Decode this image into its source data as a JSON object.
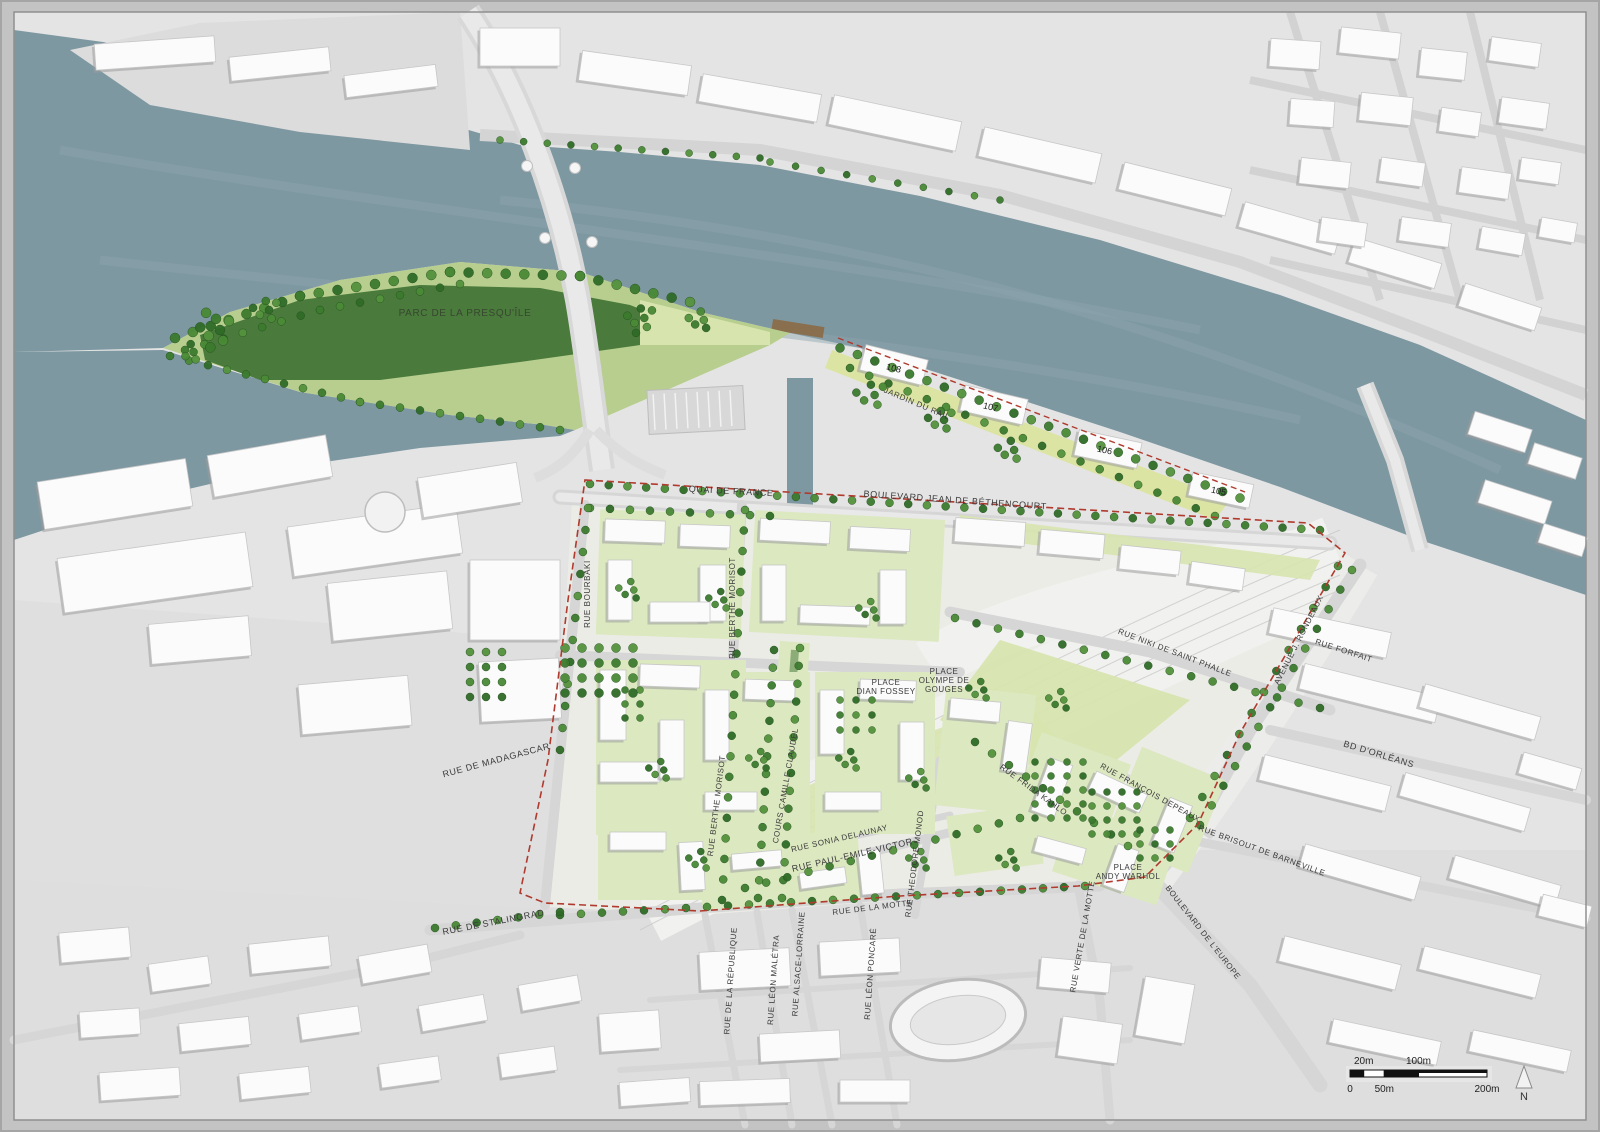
{
  "map": {
    "type": "urban-masterplan",
    "colors": {
      "frame": "#c3c3c3",
      "land": "#e4e4e4",
      "land_bottom": "#dedede",
      "dev_zone": "#ecece7",
      "water": "#7e98a2",
      "water_light": "#8ba4ac",
      "building": "#fbfbfb",
      "building_stroke": "#c7c7c7",
      "shadow": "#9c9c9c",
      "park_dark": "#4a7a3c",
      "park_light": "#b7ce8e",
      "lawn": "#d7e4ae",
      "courtyard": "#dce8c0",
      "jardin_strip": "#dce4a4",
      "tree": "#3c7b2e",
      "tree_alt": "#4a8a36",
      "tree_dark": "#2f6b27",
      "road": "#d6d6d6",
      "road_light": "#e9e9e9",
      "rail": "#f1f1ef",
      "rail_line": "#c9c9c9",
      "boundary_red": "#b03a2e",
      "dock_brown": "#8a6f4e",
      "label_text": "#3a3a3a",
      "park_label_text": "#37472f"
    },
    "labels": [
      {
        "text": "PARC DE LA  PRESQU'ÎLE",
        "x": 465,
        "y": 316,
        "rot": 0,
        "size": 10,
        "color_key": "park_label_text"
      },
      {
        "text": "JARDIN DU RAIL",
        "x": 916,
        "y": 406,
        "rot": 23,
        "size": 8
      },
      {
        "text": "QUAI DE FRANCE",
        "x": 731,
        "y": 494,
        "rot": 3,
        "size": 9
      },
      {
        "text": "BOULEVARD JEAN DE BÉTHENCOURT",
        "x": 955,
        "y": 503,
        "rot": 4,
        "size": 9
      },
      {
        "text": "RUE BOURBAKI",
        "x": 590,
        "y": 594,
        "rot": -90,
        "size": 8
      },
      {
        "text": "RUE BERTHE MORISOT",
        "x": 735,
        "y": 608,
        "rot": -90,
        "size": 8
      },
      {
        "text": "RUE BERTHE MORISOT",
        "x": 719,
        "y": 806,
        "rot": -83,
        "size": 8
      },
      {
        "text": "COURS CAMILLE CLAUDEL",
        "x": 788,
        "y": 786,
        "rot": -80,
        "size": 8
      },
      {
        "text": "RUE NIKI DE SAINT PHALLE",
        "x": 1174,
        "y": 655,
        "rot": 21,
        "size": 8
      },
      {
        "text": "AVENUE J. RONDEAUX",
        "x": 1301,
        "y": 641,
        "rot": -63,
        "size": 8
      },
      {
        "text": "RUE FORFAIT",
        "x": 1343,
        "y": 653,
        "rot": 18,
        "size": 8
      },
      {
        "text": "BD D'ORLÉANS",
        "x": 1378,
        "y": 757,
        "rot": 17,
        "size": 9
      },
      {
        "text": "RUE DE MADAGASCAR",
        "x": 497,
        "y": 763,
        "rot": -15,
        "size": 9
      },
      {
        "text": "RUE SONIA DELAUNAY",
        "x": 840,
        "y": 841,
        "rot": -13,
        "size": 8
      },
      {
        "text": "RUE PAUL-EMILE-VICTOR",
        "x": 853,
        "y": 858,
        "rot": -13,
        "size": 9
      },
      {
        "text": "RUE THEODORE MONOD",
        "x": 917,
        "y": 864,
        "rot": -83,
        "size": 8
      },
      {
        "text": "RUE FRIDA KAHLO",
        "x": 1032,
        "y": 792,
        "rot": 36,
        "size": 8
      },
      {
        "text": "RUE FRANÇOIS DEPEAUX",
        "x": 1149,
        "y": 795,
        "rot": 29,
        "size": 8
      },
      {
        "text": "RUE DE LA MOTTE",
        "x": 873,
        "y": 910,
        "rot": -7,
        "size": 8
      },
      {
        "text": "RUE VERTE DE LA MOTTE",
        "x": 1085,
        "y": 937,
        "rot": -80,
        "size": 8
      },
      {
        "text": "RUE DE STALINGRAD",
        "x": 494,
        "y": 925,
        "rot": -11,
        "size": 9
      },
      {
        "text": "RUE DE LA RÉPUBLIQUE",
        "x": 733,
        "y": 981,
        "rot": -86,
        "size": 8
      },
      {
        "text": "RUE LÉON MALÉTRA",
        "x": 776,
        "y": 980,
        "rot": -86,
        "size": 8
      },
      {
        "text": "RUE ALSACE-LORRAINE",
        "x": 801,
        "y": 964,
        "rot": -86,
        "size": 8
      },
      {
        "text": "RUE LÉON PONCARÉ",
        "x": 873,
        "y": 974,
        "rot": -86,
        "size": 8
      },
      {
        "text": "RUE BRISOUT DE BARNEVILLE",
        "x": 1261,
        "y": 853,
        "rot": 20,
        "size": 8
      },
      {
        "text": "BOULEVARD DE L'EUROPE",
        "x": 1201,
        "y": 934,
        "rot": 52,
        "size": 8
      }
    ],
    "places": [
      {
        "lines": [
          "PLACE",
          "DIAN FOSSEY"
        ],
        "x": 886,
        "y": 685
      },
      {
        "lines": [
          "PLACE",
          "OLYMPE DE",
          "GOUGES"
        ],
        "x": 944,
        "y": 674
      },
      {
        "lines": [
          "PLACE",
          "ANDY WARHOL"
        ],
        "x": 1128,
        "y": 870
      }
    ],
    "quay_building_numbers": [
      {
        "text": "108",
        "x": 893,
        "y": 371,
        "rot": 14
      },
      {
        "text": "107",
        "x": 990,
        "y": 410,
        "rot": 13
      },
      {
        "text": "106",
        "x": 1104,
        "y": 453,
        "rot": 12
      },
      {
        "text": "105",
        "x": 1218,
        "y": 494,
        "rot": 12
      }
    ],
    "scale_bar": {
      "top": [
        {
          "label": "20m",
          "x": 13.7
        },
        {
          "label": "100m",
          "x": 68.5
        }
      ],
      "bottom": [
        {
          "label": "0",
          "x": 0
        },
        {
          "label": "50m",
          "x": 34.3
        },
        {
          "label": "200m",
          "x": 137
        }
      ]
    },
    "north_label": "N"
  }
}
